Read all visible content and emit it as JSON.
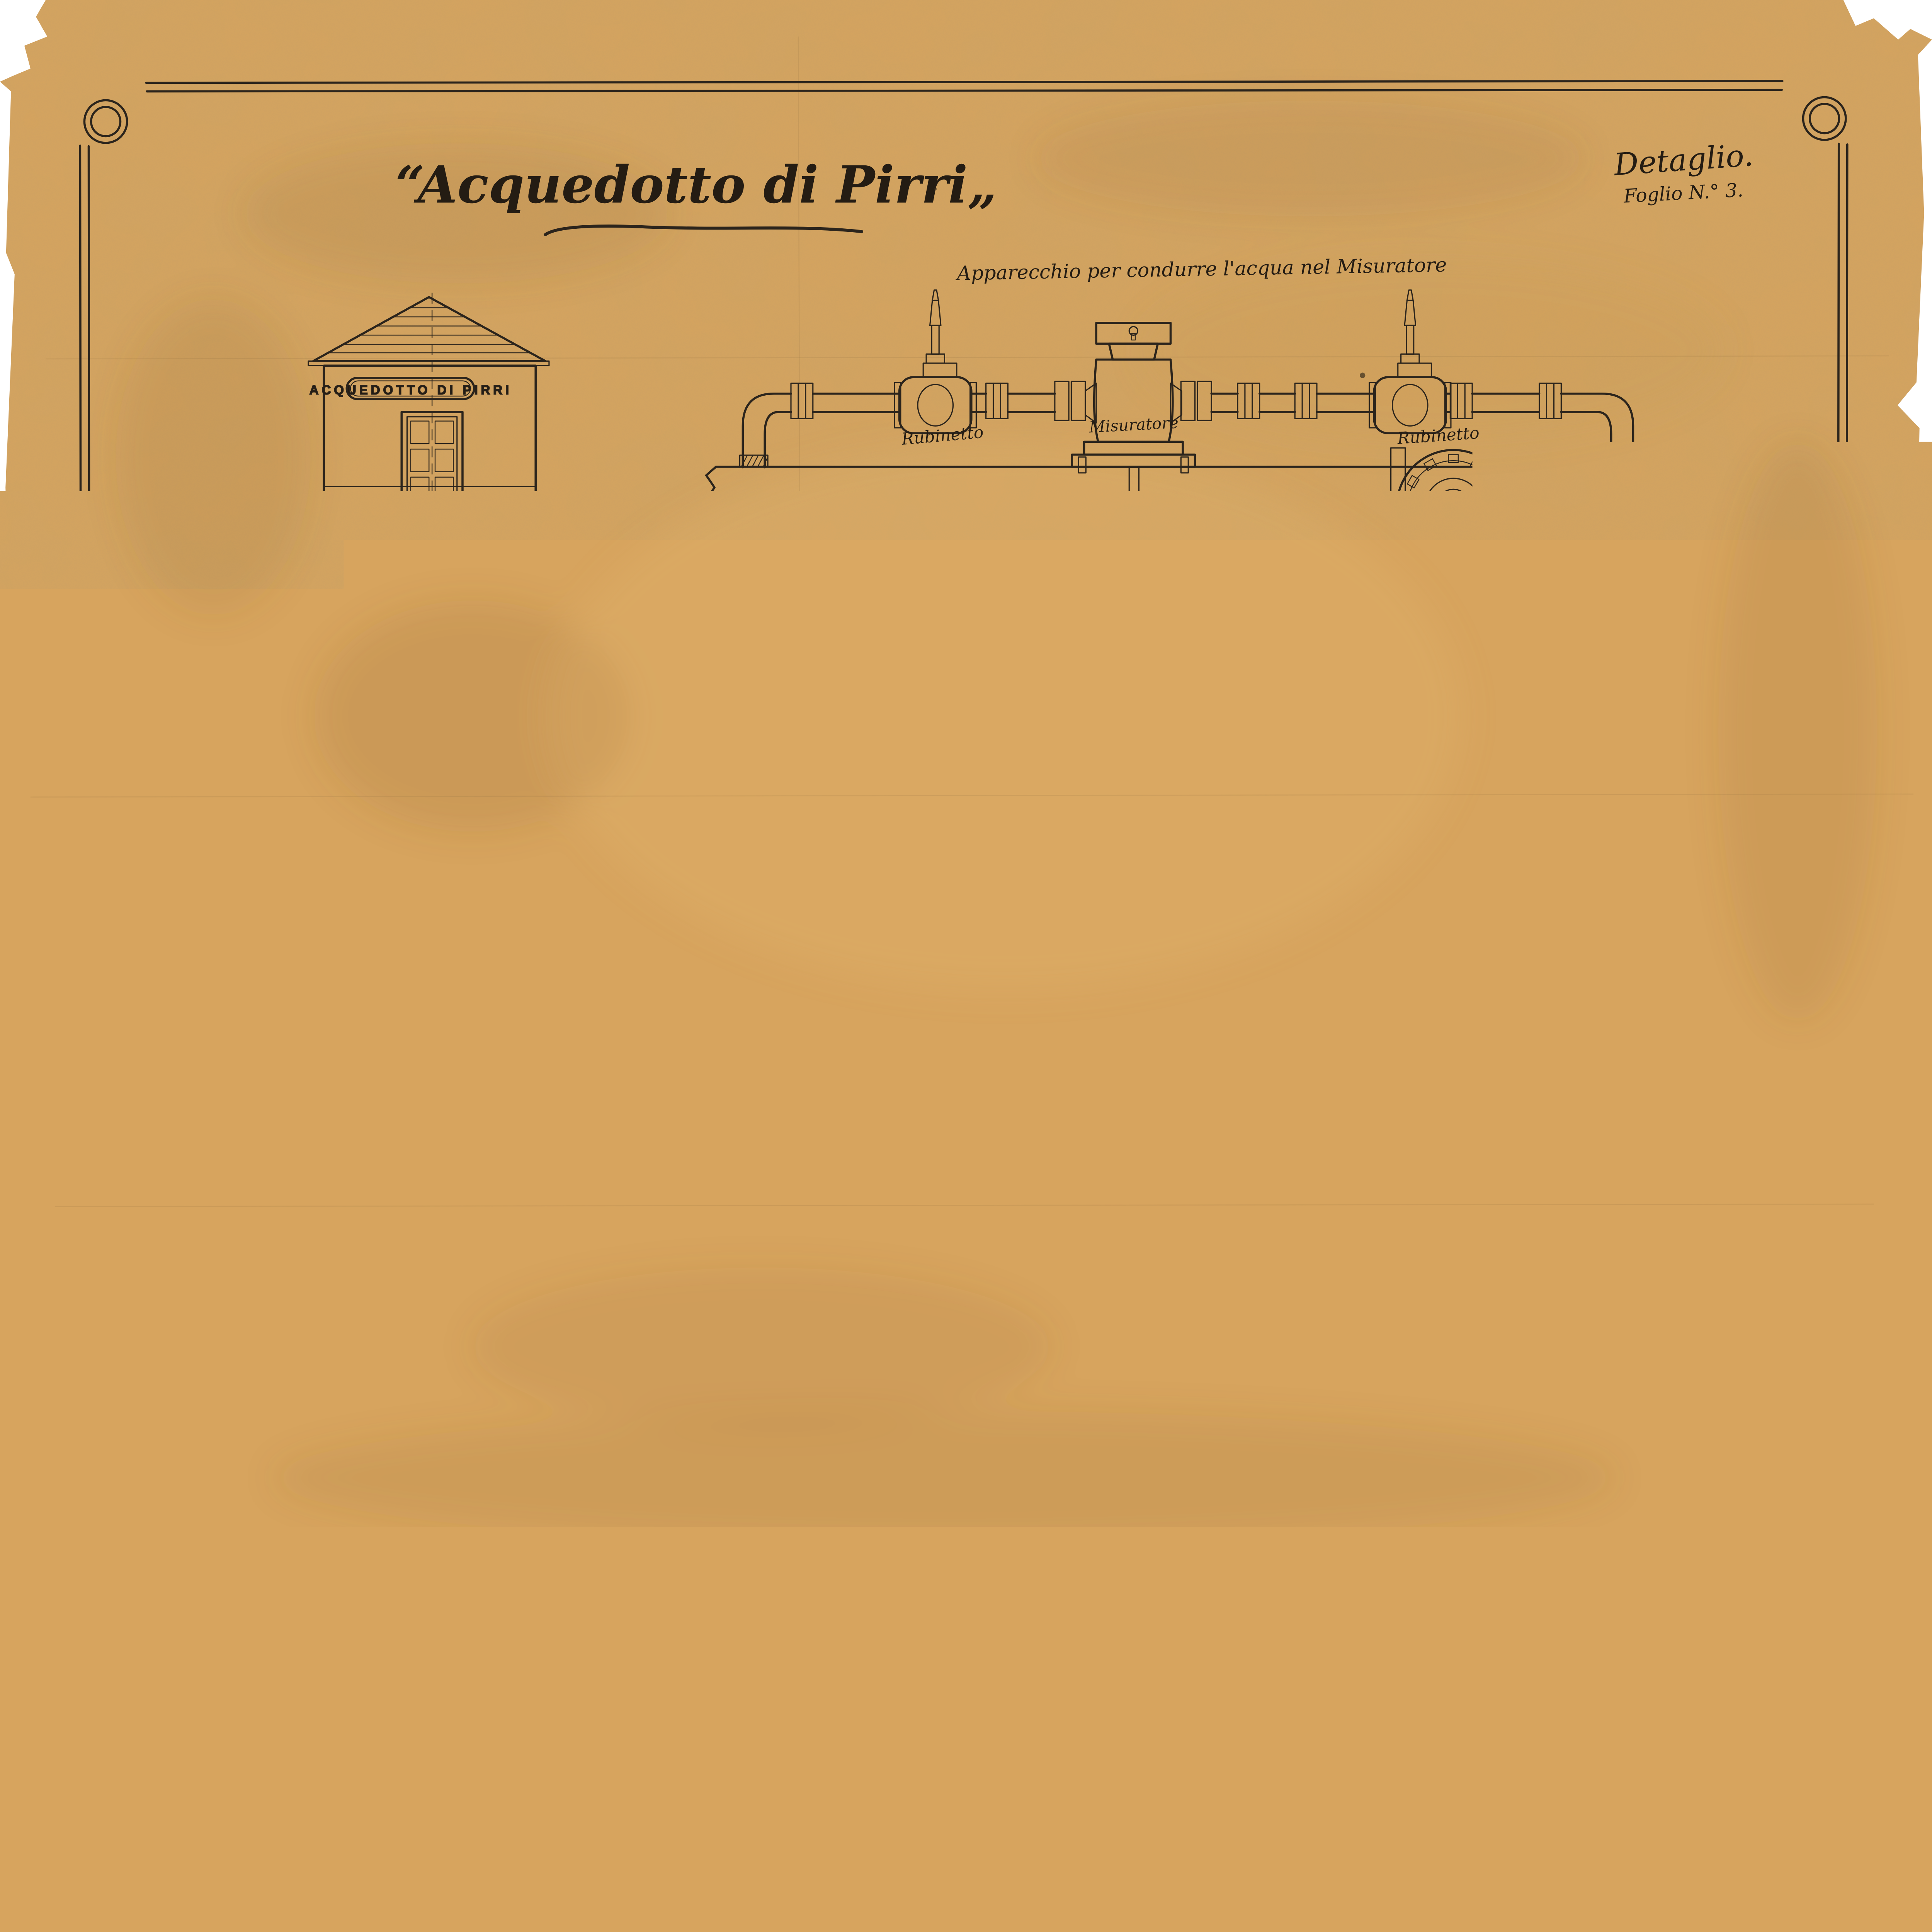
{
  "sheet": {
    "title": "“Acquedotto di Pirri„",
    "note1": "Detaglio.",
    "note2": "Foglio N.° 3.",
    "signature": "Cagliari 7 Aprile 1873."
  },
  "apparatus": {
    "caption": "Apparecchio  per condurre l'acqua nel   Misuratore",
    "valve_left": "Rubinetto",
    "meter": "Misuratore",
    "valve_right": "Rubinetto",
    "scale": "Scala metr. da 1. a 4.",
    "valve_title": "Rubinetto principale per arresto",
    "valve_sub": "( projezione orizontale )"
  },
  "facade": {
    "sign": "ACQUEDOTTO DI PIRRI",
    "caption": "Facciata."
  },
  "plan": {
    "caption": "Pianta",
    "direction": "Per Pirri",
    "diam": "Diam. m 0.101",
    "valve1": "Rubinetto",
    "meter": "Misuratore",
    "dim_width": "m 4.00",
    "valve2": "Rubinetto",
    "reduction": "Tubi di   Riduzione",
    "dim_door": "m 1.00",
    "scale_side": "Scala metr. da 1. a 50.",
    "house_side": "Casotto  per  il  Misuratore"
  },
  "aqueduct": {
    "valve_l": "Rubinetto",
    "valve_r": "per arresto",
    "diam_lbl": "Diam.",
    "diam_val": "m 0,152",
    "dest_l": "Per Cagliari",
    "dest_r": "Per Carongiu",
    "branch_l": "Tubo di",
    "branch_r": "innesto",
    "diam_main": "Diam m. 0.38",
    "caption": "Acquedotto   Principale"
  },
  "valve_section": {
    "side_label": "Rubinetto   principale   per arresto",
    "sezione": "Sezione",
    "orizzontale": "Orizzontale"
  },
  "tee": {
    "label_l": "Tubo",
    "label_r": "d' innesto",
    "sub_l": "( Sezione",
    "sub_r": "Orizzontale )",
    "dim": "m 0.152",
    "scale": "Scala metr. da 1 a 7,5"
  },
  "tubes": {
    "caption": "Tubi  di  Riduzione",
    "t1_top": "m 0.152",
    "t1_bot": "m 0.127",
    "t2_top": "m 0.101",
    "t2_bot": "m 0.127"
  },
  "section_ab": {
    "caption": "Sezione sulla linea A.B",
    "a": "A",
    "b": "B'",
    "dim_width": "m. 4.00",
    "dim_h1": "m. 2.00",
    "dim_h2": "m. 3.10",
    "dim_depth": "m. 1.00",
    "dim_wl": "m. 0.40",
    "dim_wr": "m. 0.40"
  },
  "colors": {
    "paper": "#d7a45e",
    "ink": "#2b241c",
    "red_ink": "#b93a26",
    "wash_brown": "#8d6233",
    "wash_pink": "#e59b81"
  }
}
